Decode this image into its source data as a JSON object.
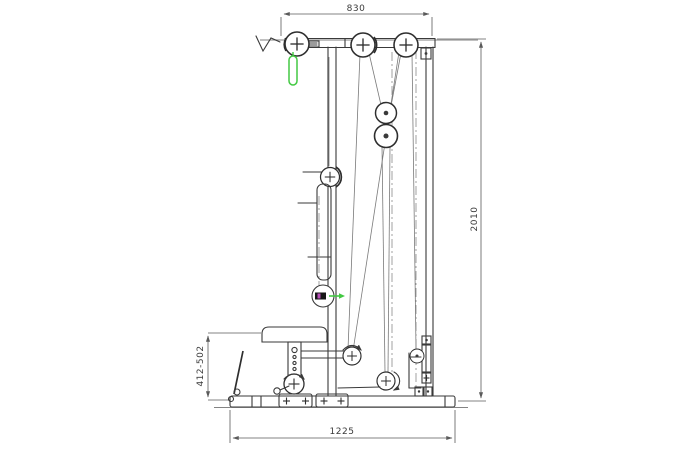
{
  "diagram": {
    "type": "technical-drawing",
    "subject": "lat-pulldown-machine-side-elevation",
    "dimensions": {
      "top_width": "830",
      "overall_height": "2010",
      "seat_height_range": "412-502",
      "base_length": "1225"
    },
    "colors": {
      "line": "#3a3a3a",
      "dim_line": "#5a5a5a",
      "light_line": "#9a9a9a",
      "accent_green": "#43c943",
      "accent_magenta": "#b84fb8",
      "background": "#ffffff"
    }
  }
}
